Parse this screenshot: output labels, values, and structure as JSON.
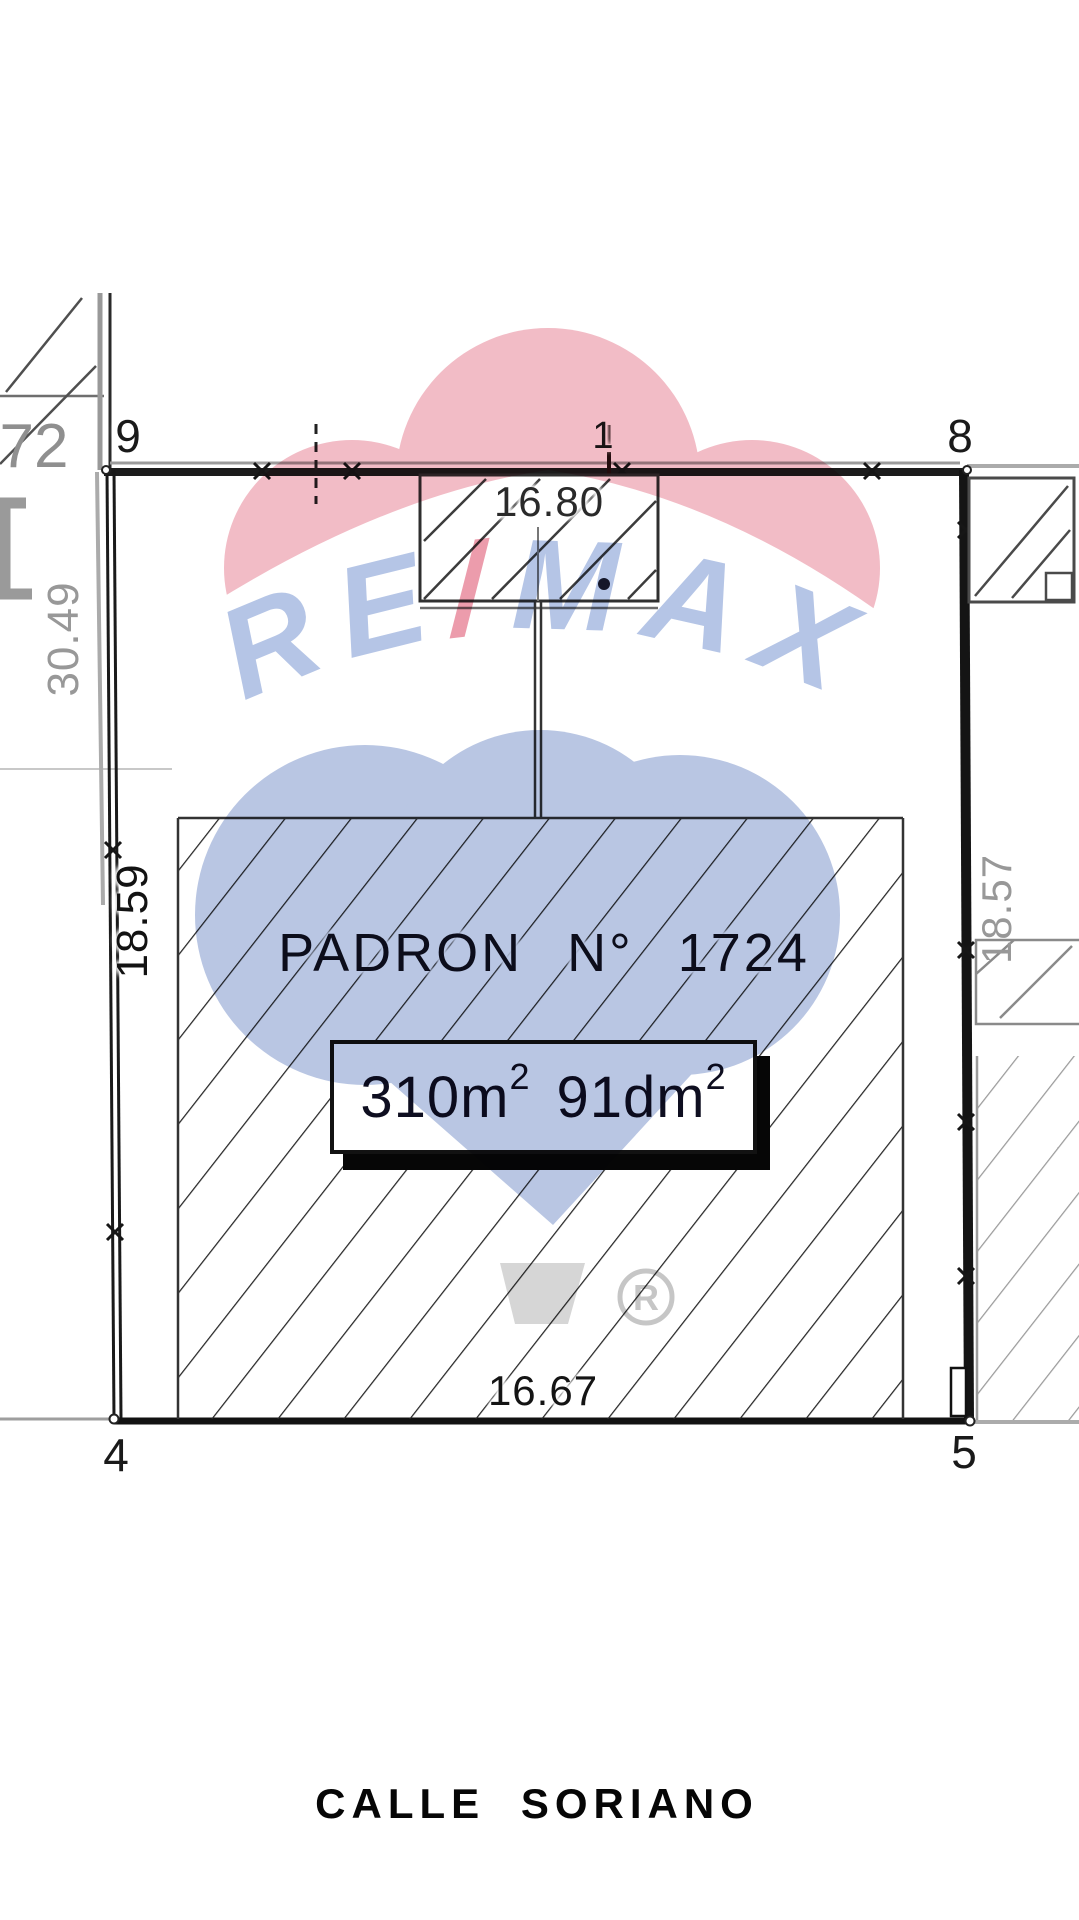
{
  "plan": {
    "street_label": "CALLE  SORIANO",
    "parcel": {
      "title": "PADRON N° 1724",
      "area_main": "310m",
      "area_main_sup": "2",
      "area_secondary": "91dm",
      "area_secondary_sup": "2"
    },
    "dimensions": {
      "top": "16.80",
      "bottom": "16.67",
      "left": "18.59",
      "left_upper_neighbor": "30.49",
      "right_neighbor": "18.57"
    },
    "corners": {
      "top_left": "9",
      "top_mid": "1",
      "top_right": "8",
      "bottom_left": "4",
      "bottom_right": "5"
    },
    "neighbor_padron_label": "72"
  },
  "watermark": {
    "brand_left": "RE",
    "brand_slash": "/",
    "brand_right": "MAX",
    "registered_mark": "R",
    "colors": {
      "balloon_pink": "#f2bcc6",
      "slash_pink": "#ec9cac",
      "brand_blue": "#b5c5e6",
      "balloon_blue": "#b9c6e3",
      "basket_gray": "#d6d6d6"
    }
  }
}
